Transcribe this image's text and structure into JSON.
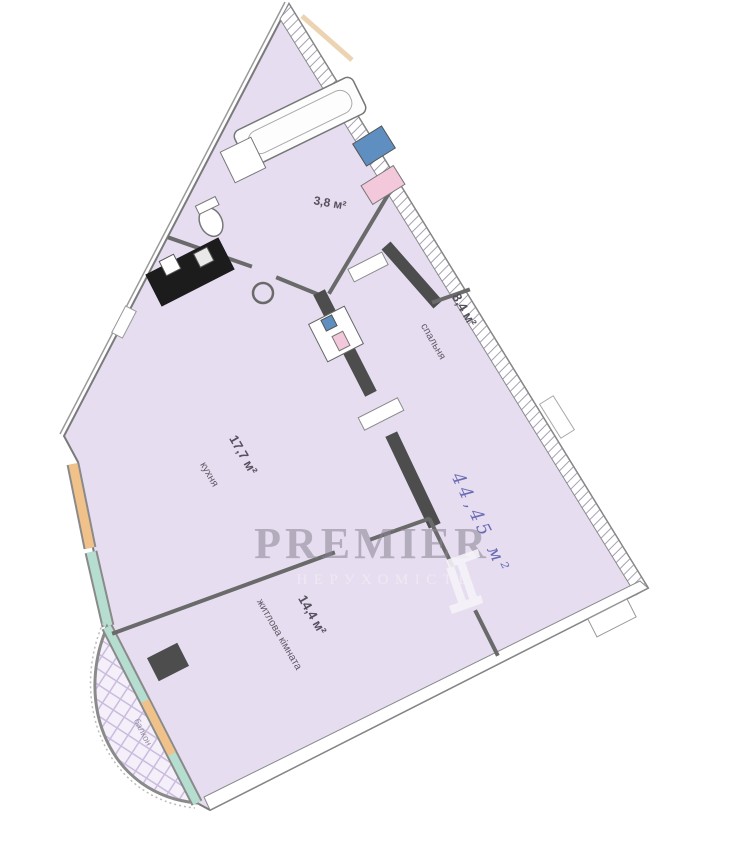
{
  "plan": {
    "rooms": [
      {
        "id": "kitchen",
        "name": "кухня",
        "area": "17,7 м²"
      },
      {
        "id": "living-room",
        "name": "житлова кімната",
        "area": "14,4 м²"
      },
      {
        "id": "bedroom",
        "name": "спальня",
        "area": "8,4 м²"
      },
      {
        "id": "bathroom",
        "name": "",
        "area": "3,8 м²"
      },
      {
        "id": "balcony",
        "name": "балкон",
        "area": ""
      }
    ],
    "handwritten_total": "44,45 м²"
  },
  "watermark": {
    "brand": "PREMIER",
    "subtitle": "НЕРУХОМІСТЬ"
  },
  "colors": {
    "room_fill": "#e6def0",
    "wall_dark": "#4d4d4d",
    "wall_gray": "#6a6a6a",
    "window_teal": "#b5ded0",
    "window_orange": "#f0c189",
    "washer_blue": "#5e8fc0",
    "sink_pink": "#f3c8da",
    "handwriting_blue": "#5d5fae",
    "label_ink": "#5f5a66",
    "watermark_gray": "#8b8494"
  }
}
